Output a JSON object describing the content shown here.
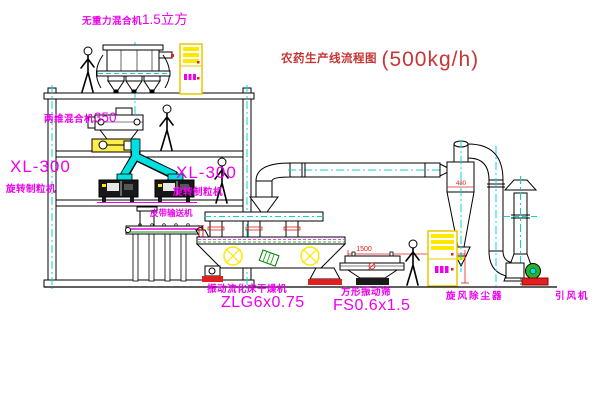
{
  "title": {
    "text": "农药生产线流程图",
    "capacity": "(500kg/h)"
  },
  "labels": {
    "gravity_mixer_name": "无重力混合机",
    "gravity_mixer_size": "1.5立方",
    "mixer350_name": "两维混合机",
    "mixer350_size": "350",
    "granulator_left_model": "XL-300",
    "granulator_left_name": "旋转制粒机",
    "granulator_right_model": "XL-300",
    "granulator_right_name": "旋转制粒机",
    "belt_conveyor": "皮带输送机",
    "dryer_name": "振动流化床干燥机",
    "dryer_model": "ZLG6x0.75",
    "screen_name": "方形振动筛",
    "screen_model": "FS0.6x1.5",
    "cyclone_name": "旋风除尘器",
    "fan_name": "引风机"
  },
  "dimensions": {
    "screen_length": "1500",
    "screen_height": "941",
    "cyclone_width": "480"
  },
  "colors": {
    "label_magenta": "#ee00ee",
    "title_red": "#c73535",
    "dimension_red": "#e02020",
    "centerline_cyan": "#00d8d8",
    "highlight_yellow": "#ffe800"
  }
}
